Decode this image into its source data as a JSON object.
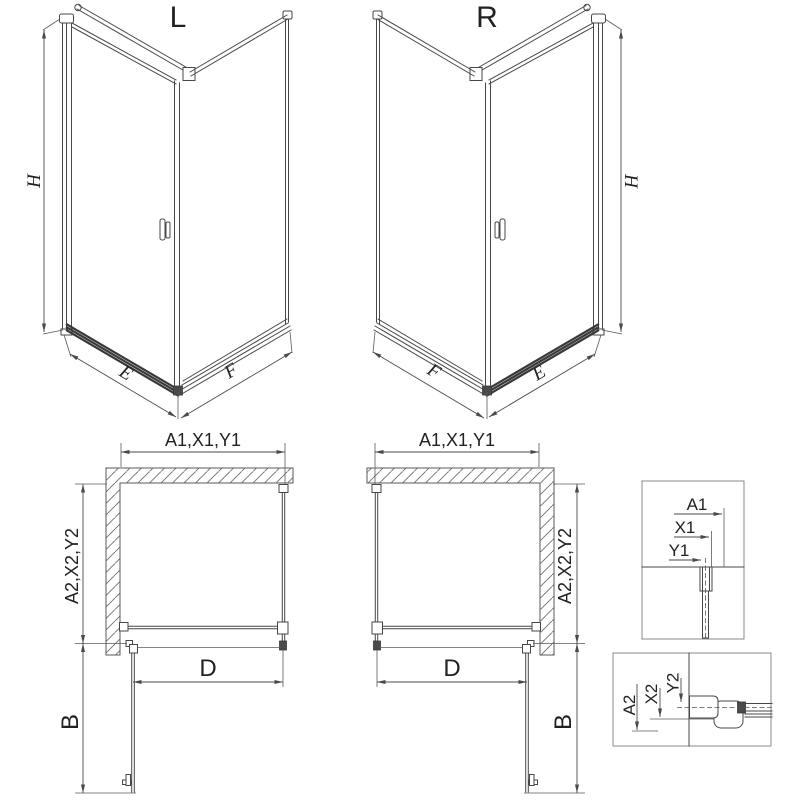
{
  "iso_left": {
    "title": "L",
    "height_dim": "H",
    "door_dim": "E",
    "panel_dim": "F"
  },
  "iso_right": {
    "title": "R",
    "height_dim": "H",
    "door_dim": "E",
    "panel_dim": "F"
  },
  "plan_left": {
    "width_dim": "A1,X1,Y1",
    "depth_dim": "A2,X2,Y2",
    "door_width_dim": "D",
    "door_swing_dim": "B"
  },
  "plan_right": {
    "width_dim": "A1,X1,Y1",
    "depth_dim": "A2,X2,Y2",
    "door_width_dim": "D",
    "door_swing_dim": "B"
  },
  "detail_top": {
    "dim_a1": "A1",
    "dim_x1": "X1",
    "dim_y1": "Y1"
  },
  "detail_bottom": {
    "dim_a2": "A2",
    "dim_x2": "X2",
    "dim_y2": "Y2"
  },
  "colors": {
    "line": "#474747",
    "dim_line": "#4a4a4a",
    "hatch": "#6e6e6e",
    "text": "#222222",
    "background": "#ffffff"
  }
}
